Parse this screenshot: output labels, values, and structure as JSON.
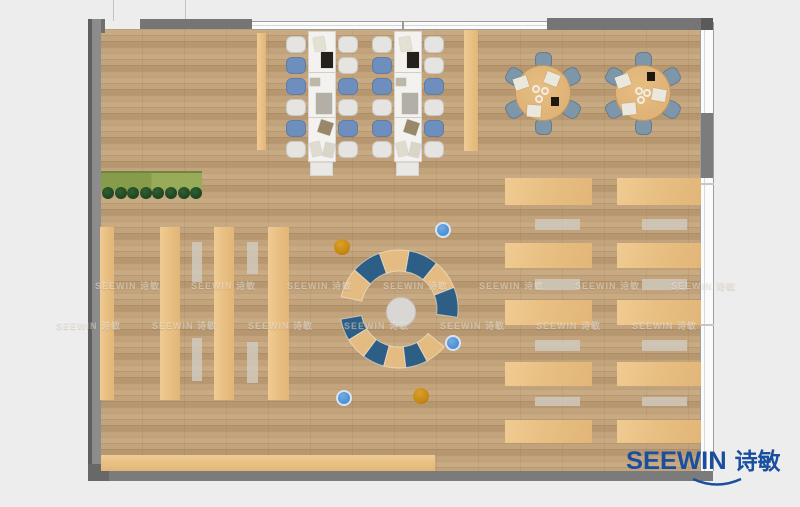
{
  "brand": {
    "en": "SEEWIN",
    "cn": "诗敏",
    "color": "#1a4fa0"
  },
  "watermark": {
    "text": "SEEWIN 诗敏",
    "rows": [
      {
        "y": 279,
        "x0": 95
      },
      {
        "y": 319,
        "x0": 56
      }
    ],
    "step": 96,
    "count": 7
  },
  "palette": {
    "exterior": "#ededed",
    "floor_base": "#c2a37c",
    "floor_dark": "#b6976f",
    "floor_light": "#c9ab83",
    "wall": "#757575",
    "wall_dark": "#5a5a5a",
    "wall_mid": "#7b7b7b",
    "window_fill": "#fbfbfb",
    "window_line": "#9e9e9e",
    "desk": "#e7bd80",
    "desk_light": "#f0cb92",
    "desk_deep": "#e2b678",
    "bench": "#d0c9bd",
    "table_white": "#f3f2ef",
    "table_border": "#d6d5d1",
    "chair_white": "#e5e4e0",
    "chair_blue": "#6e8fbe",
    "chair_gray_blue": "#7e96a9",
    "round_table": "#dfb276",
    "ring_blue": "#2d5e86",
    "ring_tan": "#e4bb80",
    "center_circle": "#d8d7d3",
    "dot_blue": "#4a8fd4",
    "dot_orange": "#c58712",
    "planter_a": "#879c4a",
    "planter_b": "#98ab58",
    "plant": "#1d4521"
  },
  "layout": {
    "canvas": {
      "w": 800,
      "h": 507
    },
    "floor": {
      "x": 101,
      "y": 29,
      "w": 599,
      "h": 442
    },
    "walls": [
      {
        "name": "wall-top-left-corner",
        "x": 88,
        "y": 19,
        "w": 17,
        "h": 14,
        "c": "#6f6f6f"
      },
      {
        "name": "wall-top-a",
        "x": 140,
        "y": 19,
        "w": 112,
        "h": 10,
        "c": "#757575"
      },
      {
        "name": "wall-top-b",
        "x": 547,
        "y": 18,
        "w": 166,
        "h": 12,
        "c": "#757575"
      },
      {
        "name": "wall-top-b-cap",
        "x": 701,
        "y": 18,
        "w": 12,
        "h": 12,
        "c": "#5a5a5a"
      },
      {
        "name": "wall-left",
        "x": 88,
        "y": 19,
        "w": 13,
        "h": 462,
        "grad": true
      },
      {
        "name": "wall-bottom",
        "x": 88,
        "y": 471,
        "w": 625,
        "h": 10,
        "c": "#7b7b7b"
      },
      {
        "name": "wall-bottom-left-corner",
        "x": 88,
        "y": 464,
        "w": 21,
        "h": 17,
        "c": "#686868"
      },
      {
        "name": "wall-right-column",
        "x": 701,
        "y": 113,
        "w": 12,
        "h": 65,
        "c": "#7c7c7c"
      }
    ],
    "windows": [
      {
        "name": "window-top",
        "x": 252,
        "y": 21,
        "w": 296,
        "h": 9,
        "orient": "h"
      },
      {
        "name": "window-right",
        "x": 700,
        "y": 22,
        "w": 14,
        "h": 449,
        "orient": "v",
        "breaks": [
          183,
          324
        ]
      }
    ],
    "mullion": {
      "x": 402,
      "y": 21,
      "h": 9
    },
    "exterior_lines": [
      {
        "x": 113,
        "y": 0,
        "h": 21
      },
      {
        "x": 185,
        "y": 0,
        "h": 19
      }
    ],
    "planter": {
      "x": 101,
      "y": 171,
      "w": 101,
      "h": 17,
      "split": 50
    },
    "plants": {
      "y": 193,
      "x0": 108,
      "step": 12.6,
      "count": 8,
      "r": 6
    },
    "cabinets": [
      {
        "x": 257,
        "y": 33,
        "w": 9,
        "h": 117
      },
      {
        "x": 464,
        "y": 30,
        "w": 14,
        "h": 121
      }
    ],
    "long_tables": {
      "y": 31,
      "h": 131,
      "w": 28,
      "cap_h": 14,
      "chair_w": 20,
      "chair_h": 17,
      "rows_y": [
        36,
        57,
        78,
        99,
        120,
        141
      ],
      "tables": [
        {
          "x": 308,
          "left_x": 286,
          "right_x": 338,
          "left": [
            "w",
            "b",
            "b",
            "w",
            "b",
            "w"
          ],
          "right": [
            "w",
            "w",
            "b",
            "w",
            "b",
            "w"
          ]
        },
        {
          "x": 394,
          "left_x": 372,
          "right_x": 424,
          "left": [
            "w",
            "b",
            "b",
            "w",
            "b",
            "w"
          ],
          "right": [
            "w",
            "w",
            "b",
            "w",
            "b",
            "w"
          ]
        }
      ],
      "items": [
        {
          "dx": 6,
          "dy": 6,
          "w": 11,
          "h": 14,
          "c": "#e4e0d2",
          "rot": -10
        },
        {
          "dx": 13,
          "dy": 21,
          "w": 12,
          "h": 16,
          "c": "#25201c",
          "rot": 0
        },
        {
          "dx": 2,
          "dy": 47,
          "w": 10,
          "h": 8,
          "c": "#bdb7aa",
          "rot": 0
        },
        {
          "dx": 8,
          "dy": 62,
          "w": 16,
          "h": 21,
          "c": "#b3aea6",
          "rot": 0
        },
        {
          "dx": 11,
          "dy": 90,
          "w": 13,
          "h": 13,
          "c": "#99876a",
          "rot": 18
        },
        {
          "dx": 3,
          "dy": 111,
          "w": 10,
          "h": 14,
          "c": "#dfdbce",
          "rot": -14
        },
        {
          "dx": 16,
          "dy": 112,
          "w": 10,
          "h": 14,
          "c": "#d9d5c8",
          "rot": 12
        }
      ]
    },
    "round_tables": {
      "r": 28,
      "chair_dist": 33,
      "chair_size": 17,
      "angles": [
        90,
        150,
        210,
        270,
        330,
        30
      ],
      "tables": [
        {
          "cx": 543,
          "cy": 93,
          "papers": [
            {
              "dx": -22,
              "dy": -10,
              "rot": -18
            },
            {
              "dx": 9,
              "dy": -14,
              "rot": 22
            },
            {
              "dx": -9,
              "dy": 18,
              "rot": 4
            }
          ],
          "dark": {
            "dx": 12,
            "dy": 8
          },
          "cups": [
            {
              "dx": -7,
              "dy": -4
            },
            {
              "dx": 2,
              "dy": -2
            },
            {
              "dx": -4,
              "dy": 6
            }
          ]
        },
        {
          "cx": 643,
          "cy": 93,
          "papers": [
            {
              "dx": -20,
              "dy": -12,
              "rot": -20
            },
            {
              "dx": 16,
              "dy": 2,
              "rot": 10
            },
            {
              "dx": -14,
              "dy": 16,
              "rot": -6
            }
          ],
          "dark": {
            "dx": 8,
            "dy": -17
          },
          "cups": [
            {
              "dx": -4,
              "dy": -2
            },
            {
              "dx": 4,
              "dy": 0
            },
            {
              "dx": -2,
              "dy": 7
            }
          ]
        }
      ]
    },
    "left_shelves": {
      "y": 227,
      "h": 173,
      "columns": [
        {
          "x": 100,
          "w": 14
        },
        {
          "x": 160,
          "w": 20
        },
        {
          "x": 214,
          "w": 20
        },
        {
          "x": 268,
          "w": 21
        }
      ],
      "benches": [
        {
          "x": 192,
          "w": 10,
          "segs": [
            {
              "y": 242,
              "h": 40
            },
            {
              "y": 338,
              "h": 43
            }
          ]
        },
        {
          "x": 247,
          "w": 11,
          "segs": [
            {
              "y": 242,
              "h": 32
            },
            {
              "y": 342,
              "h": 41
            }
          ]
        }
      ]
    },
    "right_desks": {
      "columns": [
        {
          "x": 505,
          "w": 87,
          "bx": 535,
          "bw": 45
        },
        {
          "x": 617,
          "w": 84,
          "bx": 642,
          "bw": 45
        }
      ],
      "desk_rows": [
        {
          "y": 178,
          "h": 27
        },
        {
          "y": 243,
          "h": 25
        },
        {
          "y": 300,
          "h": 25
        },
        {
          "y": 362,
          "h": 24
        },
        {
          "y": 420,
          "h": 23
        }
      ],
      "bench_rows": [
        {
          "y": 219,
          "h": 11
        },
        {
          "y": 279,
          "h": 11
        },
        {
          "y": 340,
          "h": 11
        },
        {
          "y": 397,
          "h": 9
        }
      ]
    },
    "bottom_strip": {
      "x": 101,
      "y": 455,
      "w": 334,
      "h": 16
    },
    "ring": {
      "cx": 399,
      "cy": 309,
      "outer": 59,
      "inner": 38,
      "arcs": [
        {
          "from": 168,
          "to": -8,
          "colors": [
            "tan",
            "blue",
            "tan",
            "blue",
            "tan",
            "blue"
          ]
        },
        {
          "from": 190,
          "to": 320,
          "colors": [
            "blue",
            "tan",
            "blue",
            "tan",
            "blue",
            "tan"
          ]
        }
      ],
      "center": {
        "cx": 401,
        "cy": 312,
        "r": 15
      }
    },
    "dots": [
      {
        "cx": 342,
        "cy": 247,
        "r": 8,
        "t": "orange"
      },
      {
        "cx": 443,
        "cy": 230,
        "r": 8,
        "t": "blue"
      },
      {
        "cx": 453,
        "cy": 343,
        "r": 8,
        "t": "blue"
      },
      {
        "cx": 344,
        "cy": 398,
        "r": 8,
        "t": "blue"
      },
      {
        "cx": 421,
        "cy": 396,
        "r": 8,
        "t": "orange"
      }
    ],
    "logo": {
      "x": 627,
      "y": 449,
      "swoosh": {
        "x": 691,
        "y": 477,
        "w": 52,
        "h": 12
      }
    }
  }
}
